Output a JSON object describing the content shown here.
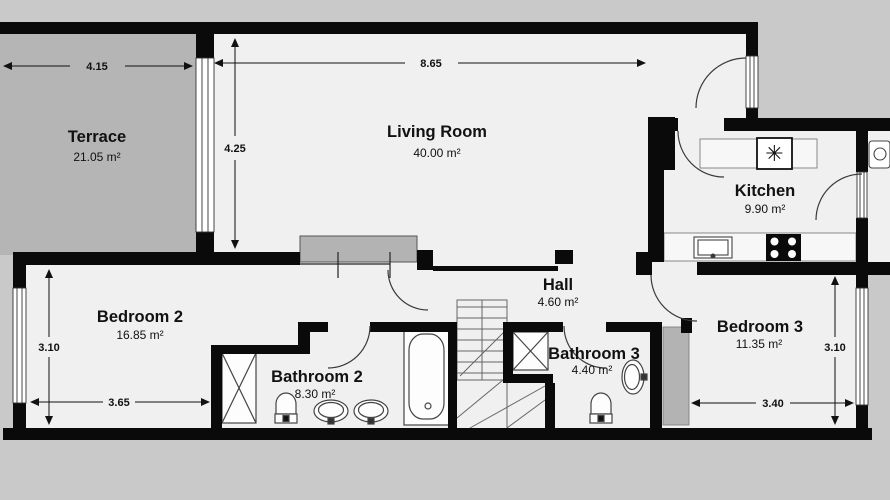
{
  "plan": {
    "rooms": [
      {
        "name": "Terrace",
        "area": "21.05 m²"
      },
      {
        "name": "Living Room",
        "area": "40.00 m²"
      },
      {
        "name": "Kitchen",
        "area": "9.90 m²"
      },
      {
        "name": "Hall",
        "area": "4.60 m²"
      },
      {
        "name": "Bedroom 2",
        "area": "16.85 m²"
      },
      {
        "name": "Bathroom 2",
        "area": "8.30 m²"
      },
      {
        "name": "Bathroom 3",
        "area": "4.40 m²"
      },
      {
        "name": "Bedroom 3",
        "area": "11.35 m²"
      }
    ],
    "dimensions": {
      "terrace_width": "4.15",
      "living_width": "8.65",
      "living_height": "4.25",
      "bedroom2_height": "3.10",
      "bedroom2_width": "3.65",
      "bedroom3_width": "3.40",
      "bedroom3_height": "3.10"
    },
    "colors": {
      "wall": "#0a0a0a",
      "floor": "#f0f0f0",
      "outside": "#c9c9c9",
      "terrace": "#b5b5b5",
      "furniture": "#b3b3b3"
    },
    "icons": {
      "boiler": "✳"
    }
  }
}
